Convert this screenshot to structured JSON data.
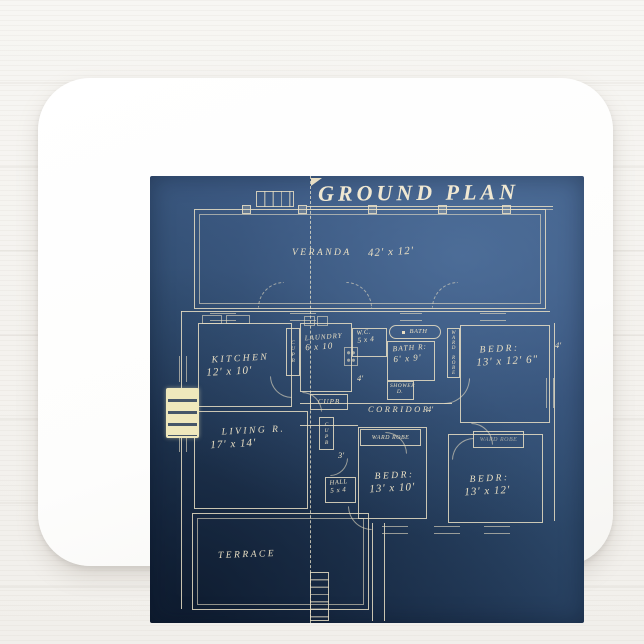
{
  "blueprint": {
    "title": "GROUND PLAN",
    "rooms": {
      "veranda": {
        "name": "VERANDA",
        "dims": "42' x 12'"
      },
      "kitchen": {
        "name": "KITCHEN",
        "dims": "12' x 10'"
      },
      "laundry": {
        "name": "LAUNDRY",
        "dims": "6 x 10"
      },
      "wc": {
        "name": "W.C.",
        "dims": "5 x 4"
      },
      "bath": {
        "tag": "BATH",
        "name": "BATH R:",
        "dims": "6' x 9'"
      },
      "shower": {
        "name": "SHOWER",
        "dims": "D."
      },
      "bedroom_ne": {
        "name": "BEDR:",
        "dims": "13' x 12' 6\""
      },
      "corridor": {
        "name": "CORRIDOR"
      },
      "living": {
        "name": "LIVING R.",
        "dims": "17' x 14'"
      },
      "hall": {
        "name": "HALL",
        "dims": "5 x 4"
      },
      "bedroom_s": {
        "name": "BEDR:",
        "dims": "13' x 10'"
      },
      "bedroom_se": {
        "name": "BEDR:",
        "dims": "13' x 12'"
      },
      "terrace": {
        "name": "TERRACE"
      }
    },
    "cupboards": [
      "CUPB",
      "CUPB",
      "CUPB"
    ],
    "wardrobes": [
      "WARD ROBE",
      "WARD ROBE",
      "WARD ROBE"
    ],
    "annotations": {
      "passage_width": "4'",
      "corridor_width": "4'",
      "hall_width": "3'",
      "wall_offset": "4'"
    }
  },
  "colors": {
    "blueprint_light": "#44638c",
    "blueprint_dark": "#1a2e49",
    "ink": "#e9dfc4",
    "fireplace": "#efe8bc",
    "mousepad": "#fdfdfc",
    "background": "#f5f3f0"
  }
}
